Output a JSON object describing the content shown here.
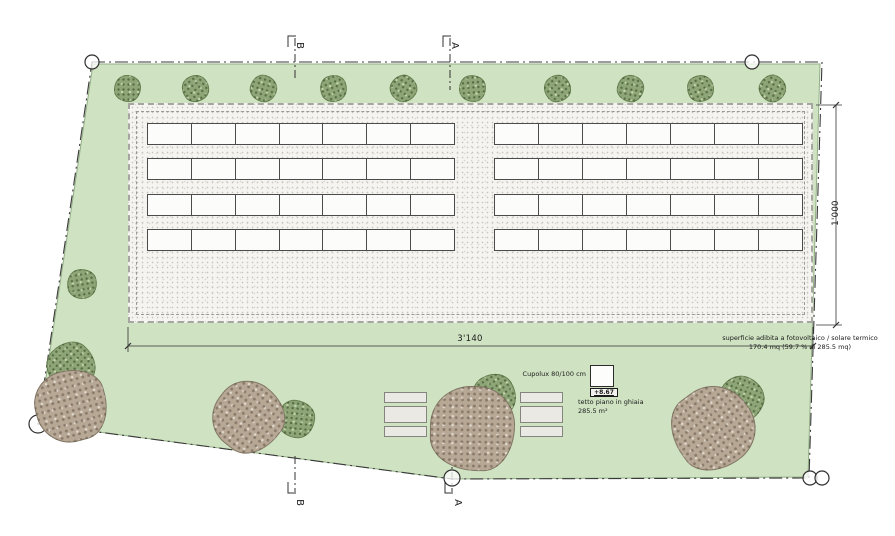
{
  "plan": {
    "section_markers": {
      "a": "A",
      "b": "B"
    },
    "dimensions": {
      "width": "3'140",
      "height": "1'000"
    },
    "roof": {
      "skylight_label": "Cupolux 80/100 cm",
      "elevation": "+8.67",
      "gravel_line1": "tetto piano in ghiaia",
      "gravel_line2": "285.5 m²",
      "pv_line1": "superficie adibita a fotovoltaico / solare termico",
      "pv_line2": "170.4 mq (59.7 % di 285.5 mq)"
    },
    "panels": {
      "blocks": 2,
      "rows": 4,
      "cells_per_row": 7
    },
    "colors": {
      "site_green": "#cfe2c2",
      "site_edge": "#93af85",
      "gravel": "#f5f4f1",
      "panel_fill": "#fcfcfb",
      "panel_stroke": "#4b4b4b",
      "tree_green": "#8ea677",
      "tree_brown": "#b7a896",
      "line": "#333333"
    }
  }
}
